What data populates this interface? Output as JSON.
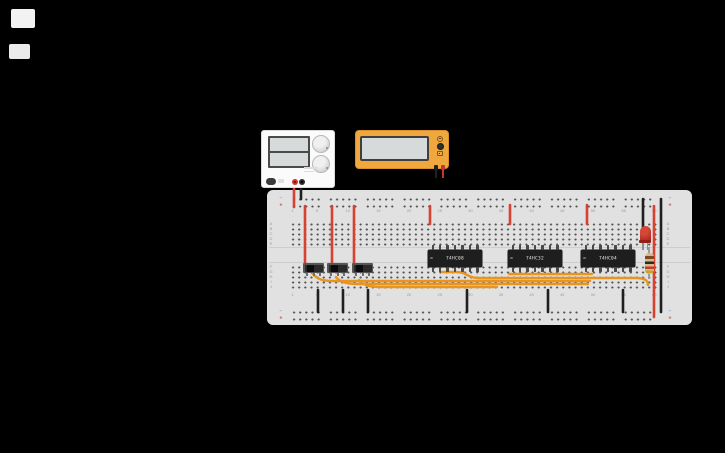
{
  "colors": {
    "canvas_background": "#000000",
    "wire_red": "#d8402f",
    "wire_black": "#1f1f1f",
    "wire_orange": "#e8941f",
    "breadboard_body": "#e1e1e1",
    "power_supply_body": "#fbfbfb",
    "multimeter_body": "#f0a73d",
    "ic_body": "#1e1e1e",
    "led_red": "#b02a20",
    "resistor_body": "#d9b98a"
  },
  "power_supply": {
    "displays": 2,
    "knobs": 2,
    "terminals": [
      "positive",
      "negative"
    ]
  },
  "multimeter": {
    "mode_buttons": 3,
    "probes": [
      "negative",
      "positive"
    ]
  },
  "breadboard": {
    "column_numbers": [
      1,
      5,
      10,
      15,
      20,
      25,
      30,
      35,
      40,
      45,
      50,
      55,
      60
    ],
    "row_letters_upper": [
      "A",
      "B",
      "C",
      "D",
      "E"
    ],
    "row_letters_lower": [
      "F",
      "G",
      "H",
      "I",
      "J"
    ],
    "negative_symbol": "−",
    "positive_symbol": "+"
  },
  "ics": [
    {
      "label": "74HC08",
      "x": 428
    },
    {
      "label": "74HC32",
      "x": 508
    },
    {
      "label": "74HC04",
      "x": 581
    }
  ],
  "switches": [
    {
      "x": 303
    },
    {
      "x": 327
    },
    {
      "x": 352
    }
  ],
  "wires": [
    {
      "name": "psu-positive-lead",
      "color": "red",
      "path": "M294,180 L294,207"
    },
    {
      "name": "psu-negative-lead",
      "color": "black",
      "path": "M301,180 L301,199"
    },
    {
      "name": "switch1-power",
      "color": "red",
      "path": "M305,206 L305,266"
    },
    {
      "name": "switch2-power",
      "color": "red",
      "path": "M332,206 L332,266"
    },
    {
      "name": "switch3-power",
      "color": "red",
      "path": "M354,206 L354,266"
    },
    {
      "name": "ic1-vcc",
      "color": "red",
      "path": "M430,206 L430,224"
    },
    {
      "name": "ic2-vcc",
      "color": "red",
      "path": "M510,205 L510,224"
    },
    {
      "name": "ic3-vcc",
      "color": "red",
      "path": "M587,205 L587,224"
    },
    {
      "name": "plus-rail-bridge",
      "color": "red",
      "path": "M654,206 L654,317"
    },
    {
      "name": "minus-rail-bridge",
      "color": "black",
      "path": "M661,199 L661,312"
    },
    {
      "name": "led-ground",
      "color": "black",
      "path": "M643,199 L643,228"
    },
    {
      "name": "gnd-jumper-1",
      "color": "black",
      "path": "M318,290 L318,312"
    },
    {
      "name": "gnd-jumper-2",
      "color": "black",
      "path": "M343,290 L343,312"
    },
    {
      "name": "gnd-jumper-3",
      "color": "black",
      "path": "M368,290 L368,312"
    },
    {
      "name": "gnd-jumper-4",
      "color": "black",
      "path": "M467,290 L467,312"
    },
    {
      "name": "gnd-jumper-5",
      "color": "black",
      "path": "M548,290 L548,312"
    },
    {
      "name": "gnd-jumper-6",
      "color": "black",
      "path": "M623,290 L623,312"
    },
    {
      "name": "signal-switch1",
      "color": "orange",
      "path": "M313,274 C317,279 322,281 334,281 L590,281"
    },
    {
      "name": "signal-switch2",
      "color": "orange",
      "path": "M336,277 C340,282 346,284 358,284 L588,284"
    },
    {
      "name": "signal-switch3",
      "color": "orange",
      "path": "M359,280 C363,285 369,287 381,287 L497,287"
    },
    {
      "name": "signal-ic1-output",
      "color": "orange",
      "path": "M442,272 L456,272 C468,272 466,278 480,278 L636,278 C644,278 648,280 648,285"
    },
    {
      "name": "signal-ic2-ic3",
      "color": "orange",
      "path": "M509,274 L592,274"
    }
  ]
}
